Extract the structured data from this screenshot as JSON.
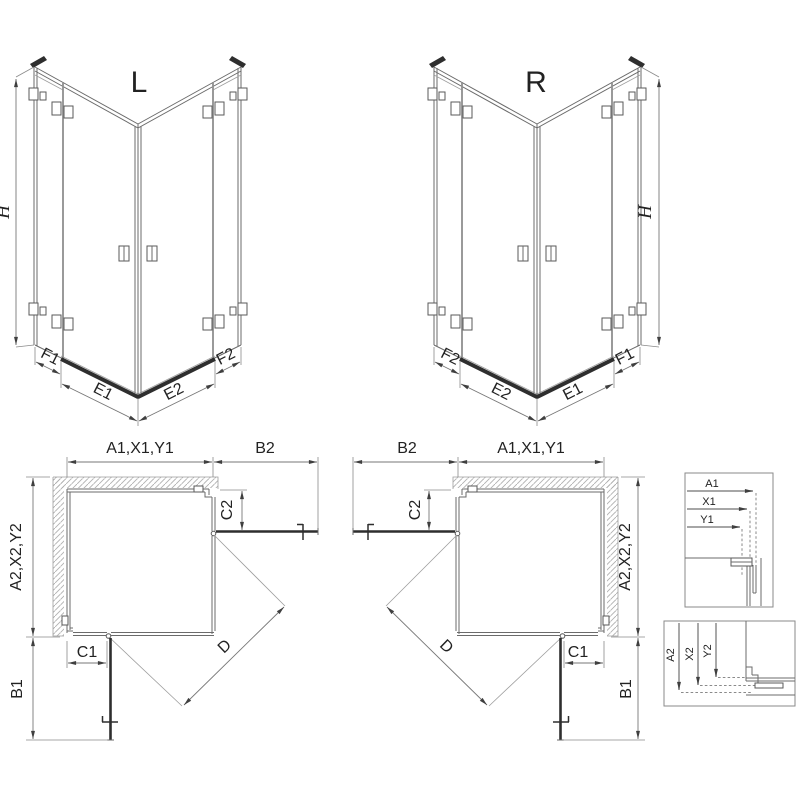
{
  "colors": {
    "background": "#ffffff",
    "line": "#6b6b6b",
    "dark": "#2e2e2e",
    "dimension": "#777777",
    "hatch": "#b0b0b0",
    "text": "#222222"
  },
  "iso_l": {
    "title": "L",
    "height_label": "H",
    "dim_labels": {
      "left_fixed": "F1",
      "left_door": "E1",
      "right_door": "E2",
      "right_fixed": "F2"
    }
  },
  "iso_r": {
    "title": "R",
    "height_label": "H",
    "dim_labels": {
      "left_fixed": "F2",
      "left_door": "E2",
      "right_door": "E1",
      "right_fixed": "F1"
    }
  },
  "plan_l": {
    "width_label": "A1,X1,Y1",
    "door_side_label": "B2",
    "depth_label": "A2,X2,Y2",
    "fixed_side_label": "C2",
    "fixed_bottom_label": "C1",
    "door_bottom_label": "B1",
    "diagonal_label": "D"
  },
  "plan_r": {
    "width_label": "A1,X1,Y1",
    "door_side_label": "B2",
    "depth_label": "A2,X2,Y2",
    "fixed_side_label": "C2",
    "fixed_bottom_label": "C1",
    "door_bottom_label": "B1",
    "diagonal_label": "D"
  },
  "detail_width": {
    "labels": [
      "A1",
      "X1",
      "Y1"
    ]
  },
  "detail_depth": {
    "labels": [
      "A2",
      "X2",
      "Y2"
    ]
  }
}
